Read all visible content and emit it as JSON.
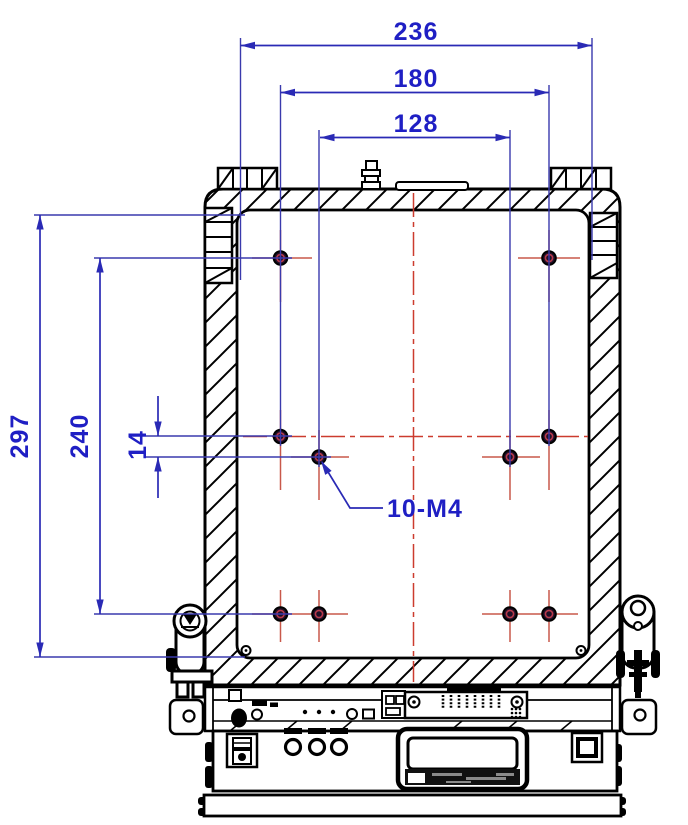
{
  "drawing": {
    "kind": "mechanical-dimension-drawing",
    "dimension_labels": {
      "width_outer": "236",
      "width_mid": "180",
      "width_inner": "128",
      "height_outer": "297",
      "height_mid": "240",
      "row_offset": "14"
    },
    "thread_callout": "10-M4",
    "holes": {
      "count": 10,
      "thread": "M4",
      "spacing_mm": {
        "outer_width": 236,
        "column_span_outer": 180,
        "column_span_inner": 128,
        "row_span": 240,
        "row_offset": 14,
        "overall_height": 297
      }
    },
    "colors": {
      "dimension_blue": "#2a2ab5",
      "label_blue": "#1f1fc4",
      "centerline_red": "#cc3b2e",
      "crosshair_red": "#c8584a",
      "outline_black": "#000000",
      "background": "#ffffff"
    }
  }
}
